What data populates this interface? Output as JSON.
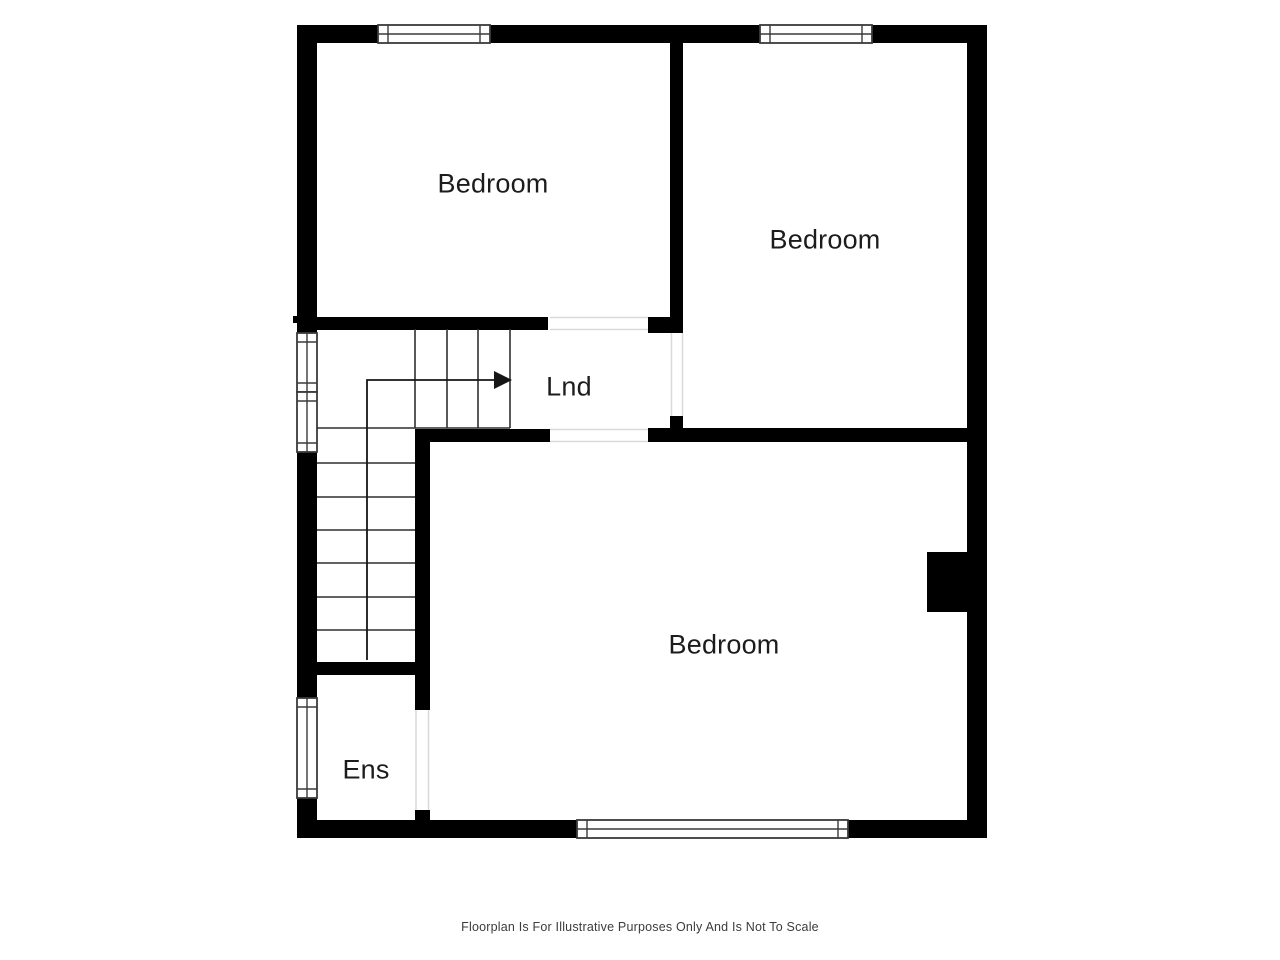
{
  "floorplan": {
    "rooms": [
      {
        "id": "bedroom-top-left",
        "label": "Bedroom"
      },
      {
        "id": "bedroom-top-right",
        "label": "Bedroom"
      },
      {
        "id": "landing",
        "label": "Lnd"
      },
      {
        "id": "bedroom-main",
        "label": "Bedroom"
      },
      {
        "id": "ensuite",
        "label": "Ens"
      }
    ],
    "disclaimer": "Floorplan Is For Illustrative Purposes Only And Is Not To Scale",
    "colors": {
      "wall": "#000000",
      "stair_line": "#2f2f2f",
      "window_frame": "#3a3a3a",
      "opening": "#d9d9d9",
      "label_text": "#1c1c1c",
      "disclaimer_text": "#3c3c3c",
      "background": "#ffffff"
    }
  }
}
